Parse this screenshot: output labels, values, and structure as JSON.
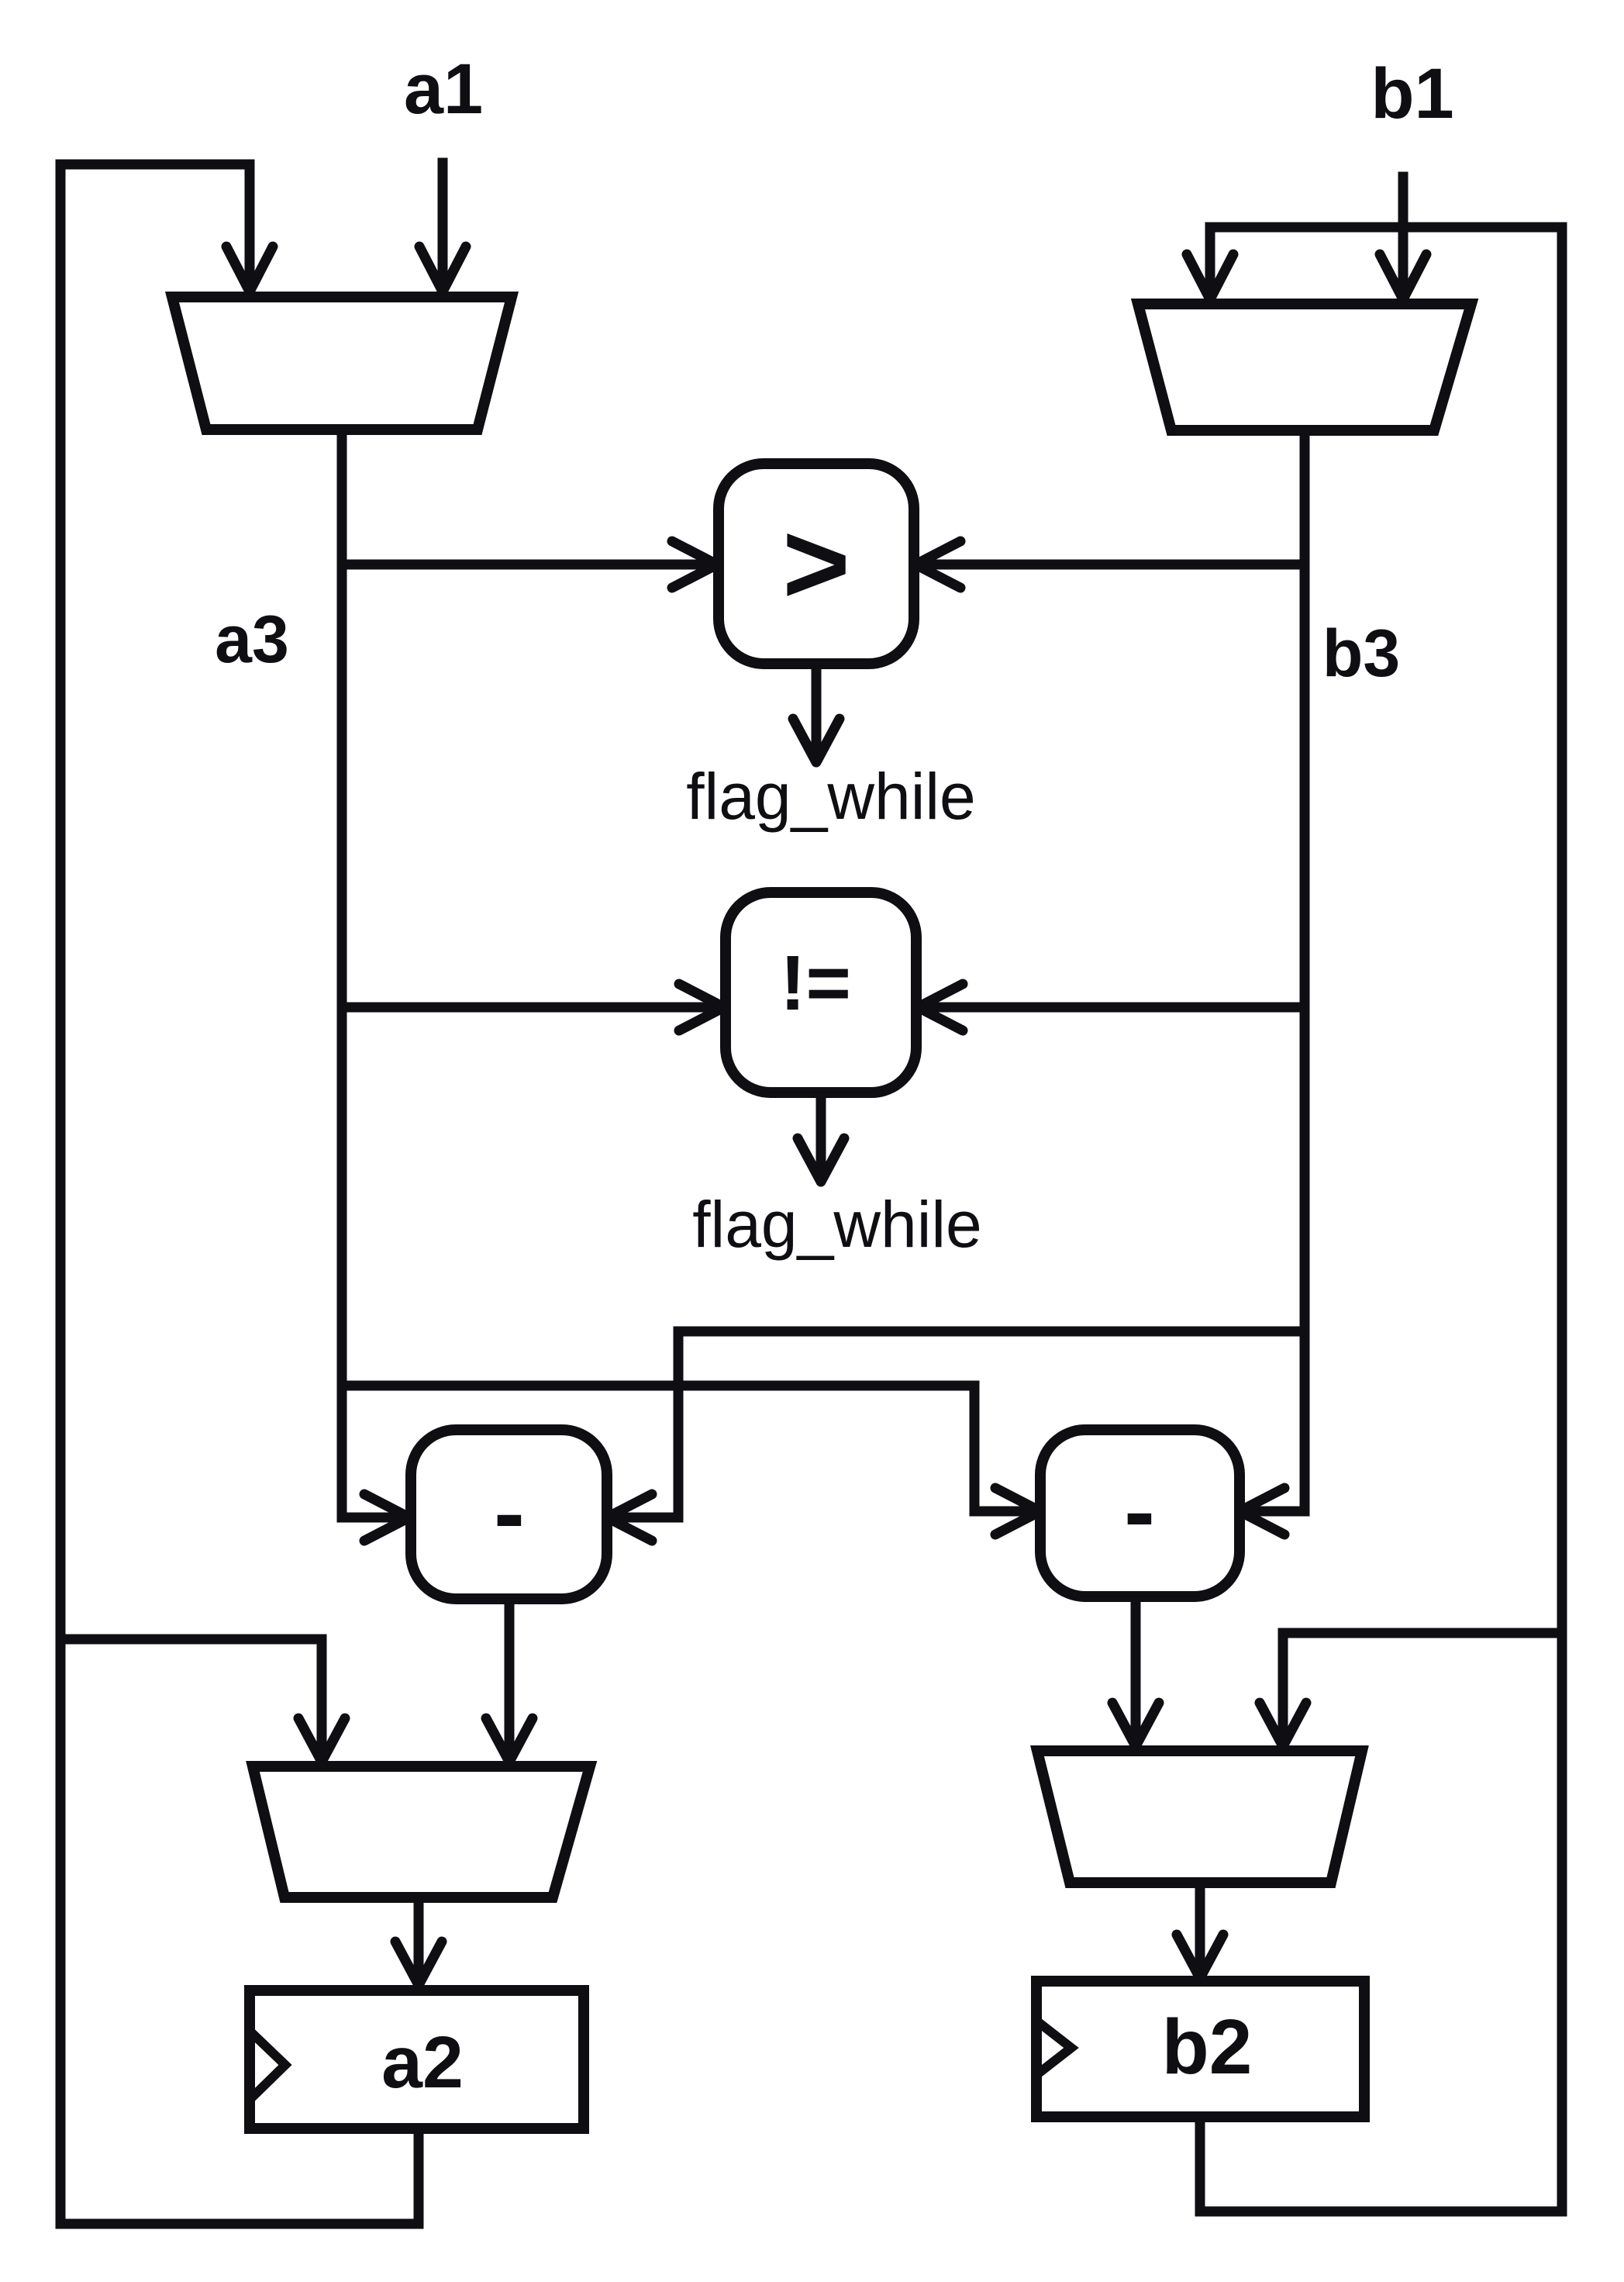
{
  "colors": {
    "ink": "#0e0e13",
    "paper": "#ffffff"
  },
  "diagram": {
    "input_a": "a1",
    "input_b": "b1",
    "bus_a": "a3",
    "bus_b": "b3",
    "comparator_gt": ">",
    "comparator_gt_flag": "flag_while",
    "comparator_neq": "!=",
    "comparator_neq_flag": "flag_while",
    "subtractor_left": "-",
    "subtractor_right": "-",
    "register_a": "a2",
    "register_b": "b2"
  }
}
